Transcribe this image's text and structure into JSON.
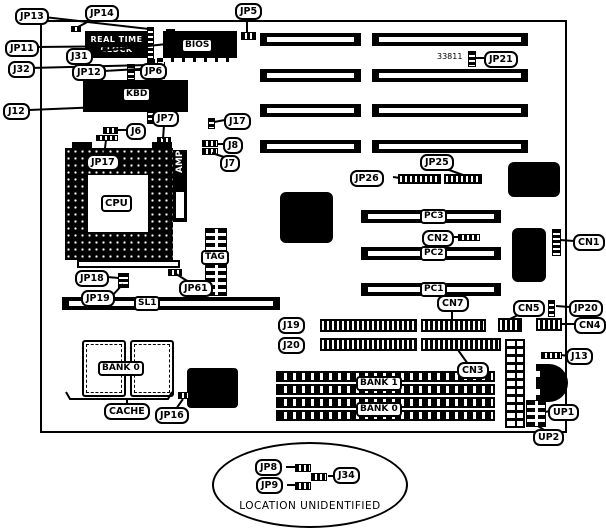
{
  "diagram": {
    "kind": "motherboard jumper/connector location diagram",
    "annotations": {
      "part_number": "33811",
      "location_note": "LOCATION UNIDENTIFIED"
    }
  },
  "chips": {
    "rtc_line1": "REAL TIME",
    "rtc_line2": "CLOCK",
    "bios": "BIOS",
    "kbd": "KBD",
    "cpu": "CPU",
    "amp": "AMP",
    "tag": "TAG"
  },
  "slots": {
    "sl1": "SL1",
    "pc1": "PC1",
    "pc2": "PC2",
    "pc3": "PC3"
  },
  "memory": {
    "bank1": "BANK 1",
    "bank0": "BANK 0",
    "cache_bank0": "BANK 0",
    "cache": "CACHE"
  },
  "labels": {
    "jp13": "JP13",
    "jp14": "JP14",
    "jp5": "JP5",
    "jp11": "JP11",
    "j31": "J31",
    "j32": "J32",
    "jp12": "JP12",
    "jp6": "JP6",
    "j12": "J12",
    "jp21": "JP21",
    "j6": "J6",
    "jp7": "JP7",
    "j17": "J17",
    "j8": "J8",
    "j7": "J7",
    "jp17": "JP17",
    "jp18": "JP18",
    "jp19": "JP19",
    "jp61": "JP61",
    "jp26": "JP26",
    "jp25": "JP25",
    "cn2": "CN2",
    "cn7": "CN7",
    "cn1": "CN1",
    "cn5": "CN5",
    "jp20": "JP20",
    "cn4": "CN4",
    "j13": "J13",
    "j19": "J19",
    "j20": "J20",
    "cn3": "CN3",
    "jp16": "JP16",
    "up1": "UP1",
    "up2": "UP2",
    "jp8": "JP8",
    "jp9": "JP9",
    "j34": "J34"
  }
}
